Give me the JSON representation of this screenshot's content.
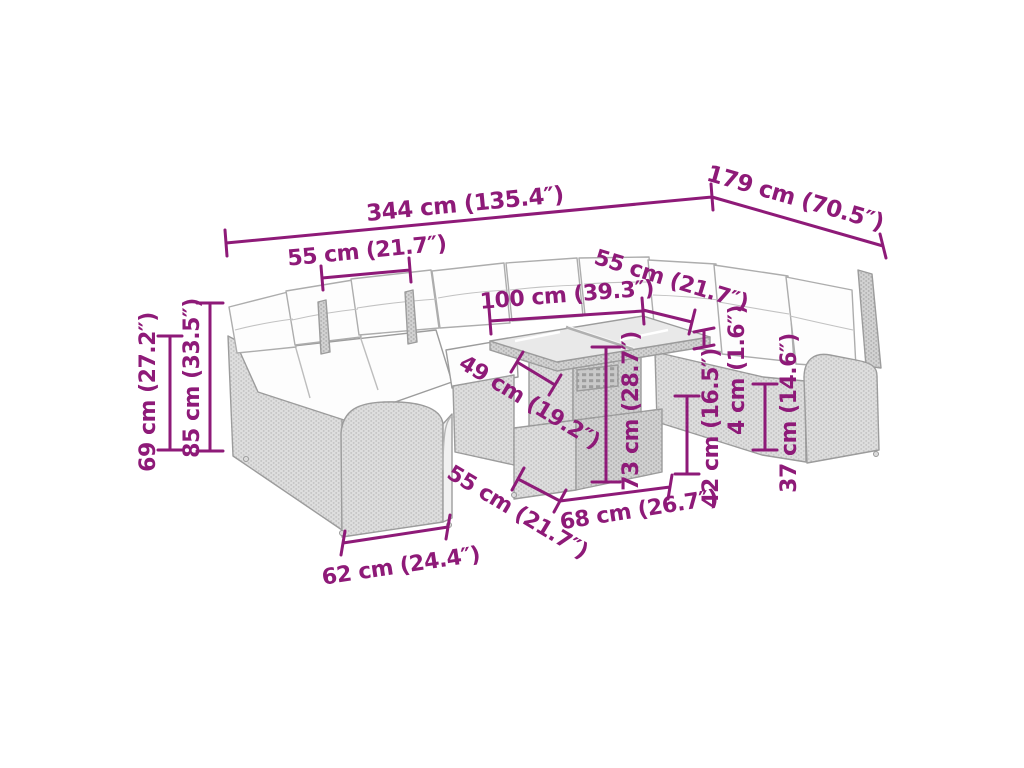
{
  "diagram": {
    "accent_color": "#8E1A78",
    "furniture_color": "#dedede",
    "dims": [
      {
        "name": "overall-width",
        "label": "344 cm (135.4″)"
      },
      {
        "name": "overall-depth",
        "label": "179 cm (70.5″)"
      },
      {
        "name": "left-seat-width",
        "label": "55 cm (21.7″)"
      },
      {
        "name": "table-length",
        "label": "100 cm (39.3″)"
      },
      {
        "name": "table-depth",
        "label": "55 cm (21.7″)"
      },
      {
        "name": "back-height",
        "label": "69 cm (27.2″)"
      },
      {
        "name": "total-height",
        "label": "85 cm (33.5″)"
      },
      {
        "name": "seat-depth",
        "label": "49 cm (19.2″)"
      },
      {
        "name": "table-height",
        "label": "73 cm (28.7″)"
      },
      {
        "name": "seat-height",
        "label": "42 cm (16.5″)"
      },
      {
        "name": "tabletop-thickness",
        "label": "4 cm (1.6″)"
      },
      {
        "name": "armrest-height",
        "label": "37 cm (14.6″)"
      },
      {
        "name": "front-seat-width",
        "label": "55 cm (21.7″)"
      },
      {
        "name": "table-base-width",
        "label": "68 cm (26.7″)"
      },
      {
        "name": "armrest-length",
        "label": "62 cm (24.4″)"
      }
    ]
  }
}
